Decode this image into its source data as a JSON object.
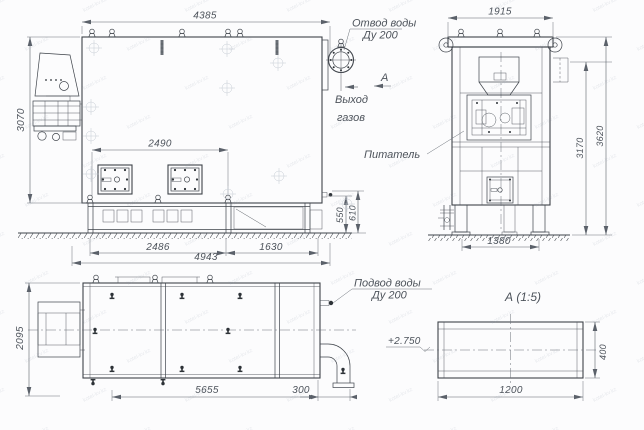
{
  "drawing": {
    "front_view": {
      "dim_top": "4385",
      "dim_left": "3070",
      "dim_doors": "2490",
      "dim_base_a": "2486",
      "dim_base_b": "1630",
      "dim_base_total": "4943",
      "dim_h_a": "550",
      "dim_h_b": "610",
      "label_water_outlet_1": "Отвод воды",
      "label_water_outlet_2": "Ду 200",
      "label_gas_1": "Выход",
      "label_gas_2": "газов",
      "section_mark": "А"
    },
    "end_view": {
      "dim_top": "1915",
      "dim_height_inner": "3170",
      "dim_height_total": "3620",
      "dim_base": "1380",
      "label_feeder": "Питатель"
    },
    "plan_view": {
      "dim_left": "2095",
      "dim_length": "5655",
      "dim_pipe": "300",
      "label_water_inlet_1": "Подвод воды",
      "label_water_inlet_2": "Ду 200"
    },
    "detail_a": {
      "title": "А  (1:5)",
      "dim_width": "1200",
      "dim_height": "400",
      "elevation": "+2.750"
    }
  },
  "watermark": {
    "text": "kotel-kv.kz"
  }
}
